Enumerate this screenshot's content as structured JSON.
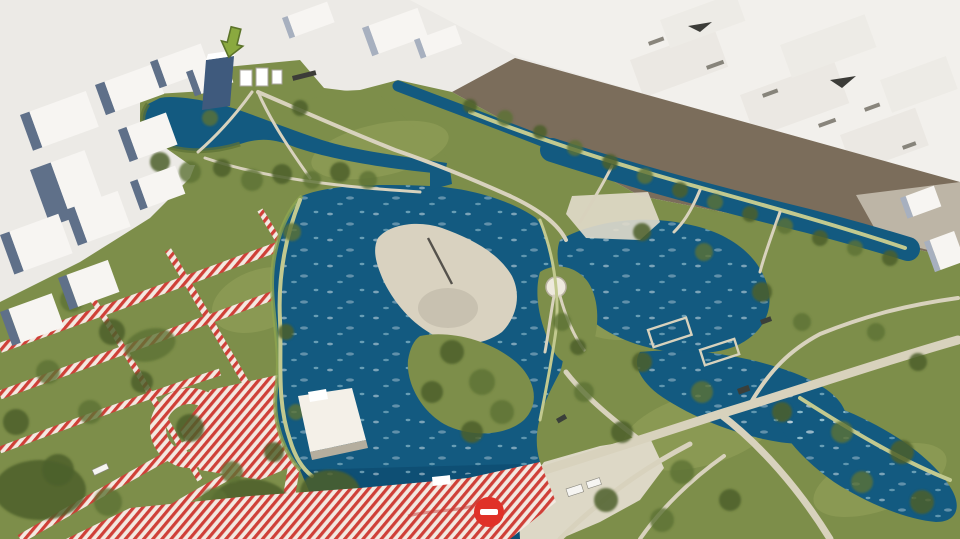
{
  "scene": {
    "type": "aerial-3d-render",
    "subject": "Bird's-eye architectural rendering of a park masterplan: lakes with a sandy island, winding paths, tree groves, red-white hatched construction zones, surrounded by white city blocks"
  },
  "icons": [
    {
      "name": "down-arrow-icon",
      "meaning": "park entrance pointer",
      "color": "#8aa93f"
    },
    {
      "name": "no-entry-icon",
      "meaning": "closed / restricted zone marker",
      "color": "#e03128"
    }
  ],
  "palette": {
    "bg": "#eceae6",
    "city_far": "#f2f0ec",
    "block_roof": "#f7f5f2",
    "block_face": "#5f7089",
    "block_face_light": "#a7b0bf",
    "glass_blue": "#3f5a7d",
    "road_brown": "#7b6d5b",
    "park_green": "#7d8e4a",
    "lawn_light": "#97a45c",
    "tree_dark": "#4c5f2c",
    "tree_mid": "#5d7236",
    "water": "#135a80",
    "water_deep": "#0e4f74",
    "ripple": "#bfe3ea",
    "sand": "#d9d2c0",
    "sand_shadow": "#b9b2a2",
    "path_beige": "#d8d2bd",
    "path_green": "#c2c98f",
    "plaza": "#ddd8c6",
    "hatch_red": "#cf4038",
    "hatch_bg": "#f3e9e1",
    "sign_red": "#e03128",
    "arrow_green": "#8aa93f",
    "arrow_outline": "#5c742a",
    "vehicle_dark": "#3a3f3a"
  }
}
